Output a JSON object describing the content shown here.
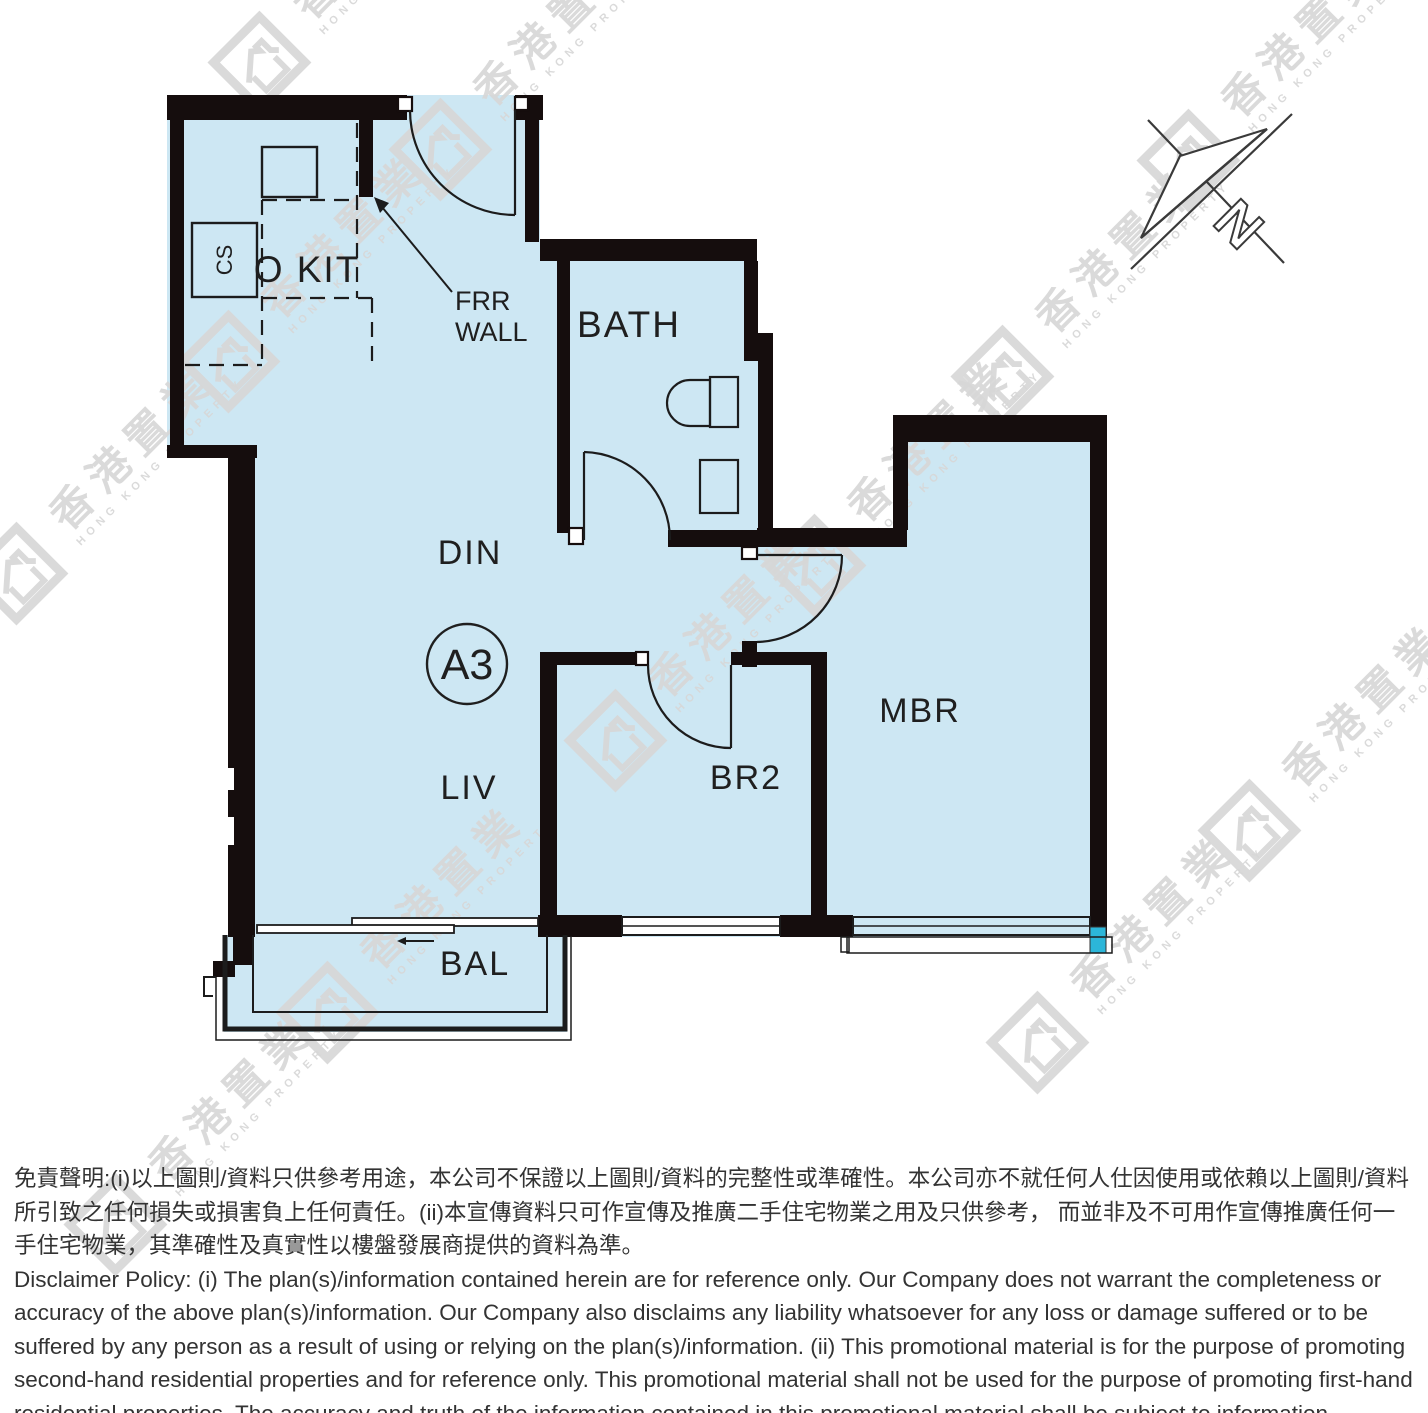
{
  "plan": {
    "unit_label": "A3",
    "rooms": {
      "open_kitchen": "O KIT",
      "bath": "BATH",
      "dining": "DIN",
      "living": "LIV",
      "bedroom2": "BR2",
      "master_bedroom": "MBR",
      "balcony": "BAL"
    },
    "annotations": {
      "frr_line1": "FRR",
      "frr_line2": "WALL",
      "stove": "CS"
    },
    "compass_letter": "N"
  },
  "watermark": {
    "zh": "香港置業",
    "en": "HONG KONG PROPERTY"
  },
  "disclaimer": {
    "zh": "免責聲明:(i)以上圖則/資料只供參考用途，本公司不保證以上圖則/資料的完整性或準確性。本公司亦不就任何人仕因使用或依賴以上圖則/資料所引致之任何損失或損害負上任何責任。(ii)本宣傳資料只可作宣傳及推廣二手住宅物業之用及只供參考， 而並非及不可用作宣傳推廣任何一手住宅物業，其準確性及真實性以樓盤發展商提供的資料為準。",
    "en": "Disclaimer Policy: (i) The plan(s)/information contained herein are for reference only. Our Company does not warrant the completeness or accuracy of the above plan(s)/information. Our Company also disclaims any liability whatsoever for any loss or damage suffered or to be suffered by any person as a result of using or relying on the plan(s)/information. (ii) This promotional material is for the purpose of promoting second-hand residential properties and for reference only. This promotional material shall not be used for the purpose of promoting first-hand residential properties. The accuracy and truth of the information contained in this promotional material shall be subject to information provided by the developers."
  },
  "colors": {
    "room_fill": "#cde7f3",
    "wall": "#150d0d",
    "accent_cyan": "#2cb6d9",
    "watermark_gray": "#d7d7d7"
  }
}
